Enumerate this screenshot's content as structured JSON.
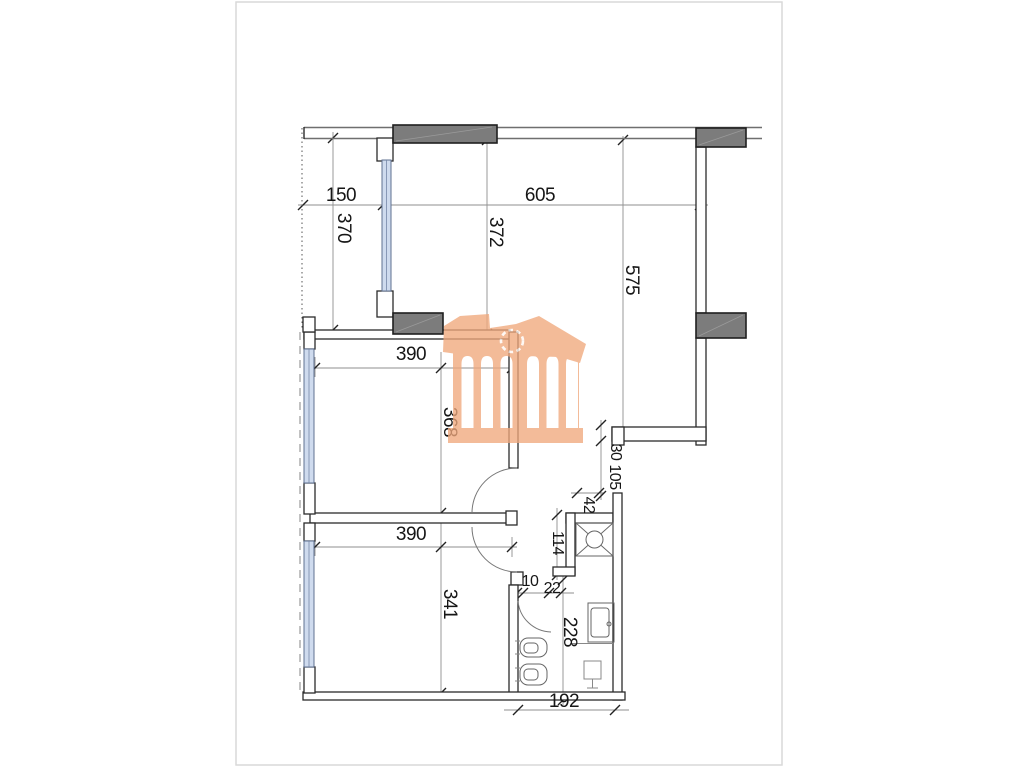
{
  "document": {
    "kind": "architectural floor plan sheet",
    "sheet_background": "#ffffff",
    "sheet_border": "#d9d9d9"
  },
  "colors": {
    "wall_line": "#2b2b2b",
    "soft_line": "#6f6f6f",
    "dim_line": "#8f8f8f",
    "column_gray": "#7c7c7c",
    "window_blue": "#cfdbee",
    "window_edge": "#5f7090",
    "watermark_orange": "#f0a87c",
    "dim368_orange": "#a8622a"
  },
  "dims": {
    "d150": "150",
    "d605": "605",
    "d370": "370",
    "d372": "372",
    "d575": "575",
    "d390_top": "390",
    "d368": "368",
    "d30": "30",
    "d105": "105",
    "d42": "42",
    "d114": "114",
    "d10": "10",
    "d22": "22",
    "d390_bottom": "390",
    "d341": "341",
    "d228": "228",
    "d192": "192"
  },
  "icons": {
    "watermark": "temple-watermark-logo",
    "shower": "shower-icon",
    "toilet": "toilet-icon",
    "bidet": "bidet-icon",
    "sink": "vanity-sink-icon",
    "boiler": "boiler-icon",
    "doors": "door-swing-arc"
  }
}
